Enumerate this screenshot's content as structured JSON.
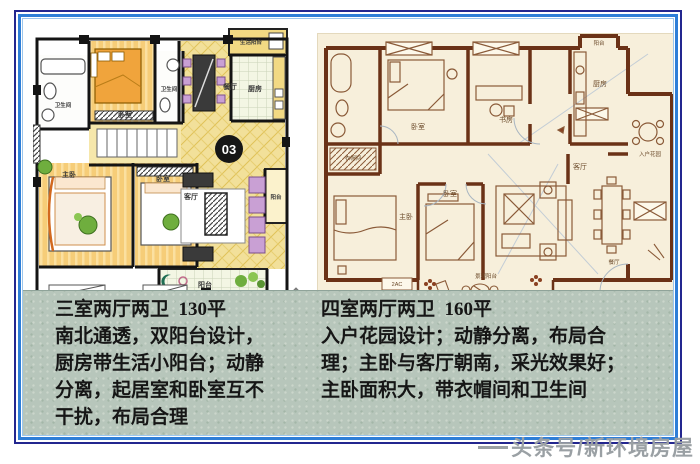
{
  "colors": {
    "frame_navy": "#23268f",
    "frame_blue": "#2e7ed7",
    "desc_band_green": "#b7c6bb",
    "right_plan_cream": "#f7efdb",
    "right_plan_wall_brown": "#6b3217",
    "left_plan_yellow": "#f2df9a",
    "badge_black": "#161616"
  },
  "watermark": "头条号/新环境房屋",
  "left_unit": {
    "badge": "03",
    "rooms": {
      "bath1": "卫生间",
      "bedroom_top": "卧室",
      "bath2": "卫生间",
      "dining": "餐厅",
      "service_balcony": "生活阳台",
      "kitchen": "厨房",
      "master": "主卧",
      "bedroom_bottom": "卧室",
      "living": "客厅",
      "balcony_side": "阳台",
      "balcony_bottom": "阳台"
    },
    "description": {
      "lines": [
        "三室两厅两卫  130平",
        "南北通透，双阳台设计，",
        "厨房带生活小阳台；动静",
        "分离，起居室和卧室互不",
        "干扰，布局合理"
      ]
    }
  },
  "right_unit": {
    "rooms": {
      "bedroom_top": "卧室",
      "study": "书房",
      "kitchen": "厨房",
      "balcony_top": "阳台",
      "entry_garden": "入户花园",
      "closet": "衣帽间",
      "master": "主卧",
      "bedroom_bottom": "卧室",
      "living": "客厅",
      "dining": "餐厅",
      "view_balcony": "景观阳台",
      "ac_unit": "2AC"
    },
    "description": {
      "lines": [
        "四室两厅两卫  160平",
        "入户花园设计；动静分离，布局合",
        "理；主卧与客厅朝南，采光效果好；",
        "主卧面积大，带衣帽间和卫生间"
      ]
    }
  }
}
